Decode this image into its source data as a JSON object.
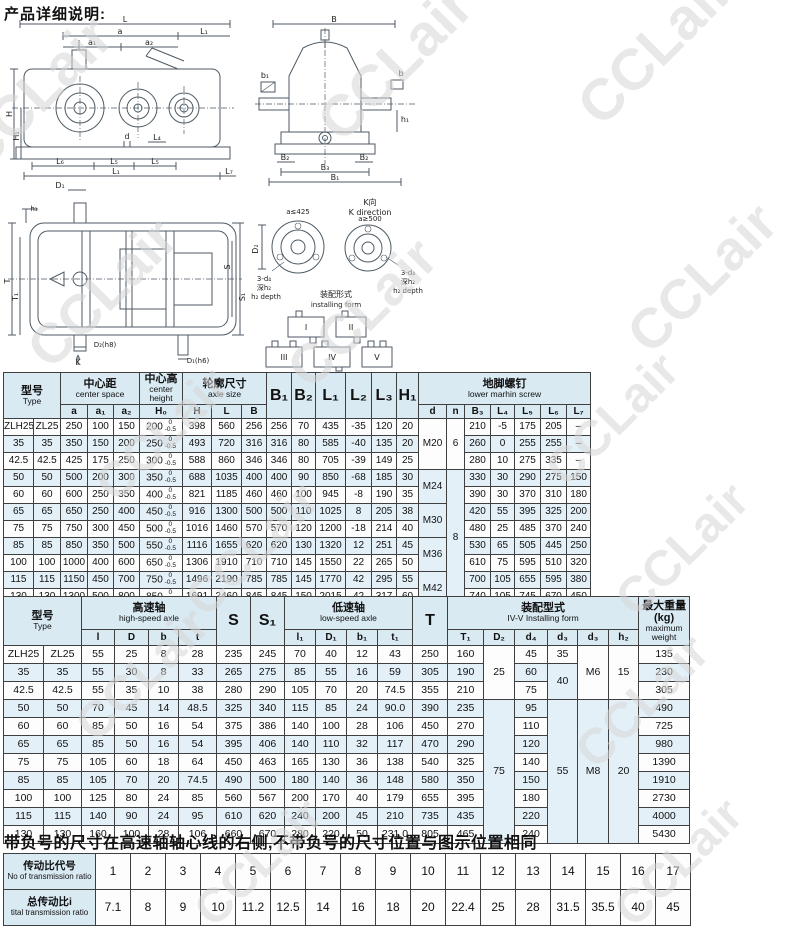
{
  "page": {
    "title": "产品详细说明:"
  },
  "note": "带负号的尺寸在高速轴轴心线的右侧,不带负号的尺寸位置与图示位置相同",
  "watermark": {
    "text": "CCLair",
    "color": "#d7d7d7"
  },
  "drawings": {
    "front": {
      "L": "L",
      "a": "a",
      "a1": "a₁",
      "a2": "a₂",
      "L1": "L₁",
      "H": "H",
      "H1": "H₁",
      "d": "d",
      "L4": "L₄",
      "L6": "L₆",
      "L5": "L₅",
      "L5b": "L₅",
      "L1b": "L₁",
      "L7": "L₇",
      "D1": "D₁"
    },
    "side": {
      "B": "B",
      "b1": "b₁",
      "b": "b",
      "h1": "h₁",
      "B2": "B₂",
      "B2b": "B₂",
      "B3": "B₃",
      "B1": "B₁"
    },
    "top": {
      "T": "T",
      "T1": "T₁",
      "h1": "h₁",
      "D2": "D₂(h8)",
      "K": "K",
      "D1": "D₁(h6)",
      "S": "S",
      "S1": "S₁"
    },
    "kdir": {
      "title_cn": "K向",
      "title_en": "K direction",
      "circle1": "a≤425",
      "circle2": "a≥500",
      "d2": "D₂",
      "note1a": "3-d₄",
      "note1b": "深h₂",
      "note1c": "h₂ depth",
      "note2a": "3-d₄",
      "note2b": "深h₂",
      "note2c": "h₂ depth",
      "caption_cn": "装配形式",
      "caption_en": "installing form",
      "forms": [
        "I",
        "II",
        "III",
        "IV",
        "V"
      ]
    }
  },
  "table1": {
    "head": [
      [
        {
          "cn": "型号",
          "en": "Type",
          "cs": 2,
          "rs": 2
        },
        {
          "cn": "中心距",
          "en": "center space",
          "cs": 3
        },
        {
          "cn": "中心高",
          "en": "center height"
        },
        {
          "cn": "轮廓尺寸",
          "en": "axle size",
          "cs": 3
        },
        {
          "t": "B₁",
          "rs": 2
        },
        {
          "t": "B₂",
          "rs": 2
        },
        {
          "t": "L₁",
          "rs": 2
        },
        {
          "t": "L₂",
          "rs": 2
        },
        {
          "t": "L₃",
          "rs": 2
        },
        {
          "t": "H₁",
          "rs": 2
        },
        {
          "cn": "地脚螺钉",
          "en": "lower marhin screw",
          "cs": 7
        }
      ],
      [
        "a",
        "a₁",
        "a₂",
        "H₀",
        "H",
        "L",
        "B",
        "d",
        "n",
        "B₃",
        "L₄",
        "L₅",
        "L₆",
        "L₇"
      ]
    ],
    "body": [
      [
        "ZLH25",
        "ZL25",
        "250",
        "100",
        "150",
        {
          "t": "200",
          "tol": [
            "0",
            "-0.5"
          ]
        },
        "398",
        "560",
        "256",
        "256",
        "70",
        "435",
        "-35",
        "120",
        "20",
        {
          "t": "M20",
          "rs": 3
        },
        {
          "t": "6",
          "rs": 3
        },
        "210",
        "-5",
        "175",
        "205",
        "–"
      ],
      [
        "35",
        "35",
        "350",
        "150",
        "200",
        {
          "t": "250",
          "tol": [
            "0",
            "-0.5"
          ]
        },
        "493",
        "720",
        "316",
        "316",
        "80",
        "585",
        "-40",
        "135",
        "20",
        "260",
        "0",
        "255",
        "255",
        "–"
      ],
      [
        "42.5",
        "42.5",
        "425",
        "175",
        "250",
        {
          "t": "300",
          "tol": [
            "0",
            "-0.5"
          ]
        },
        "588",
        "860",
        "346",
        "346",
        "80",
        "705",
        "-39",
        "149",
        "25",
        "280",
        "10",
        "275",
        "335",
        "–"
      ],
      [
        "50",
        "50",
        "500",
        "200",
        "300",
        {
          "t": "350",
          "tol": [
            "0",
            "-0.5"
          ]
        },
        "688",
        "1035",
        "400",
        "400",
        "90",
        "850",
        "-68",
        "185",
        "30",
        {
          "t": "M24",
          "rs": 2
        },
        {
          "t": "8",
          "rs": 8
        },
        "330",
        "30",
        "290",
        "275",
        "150"
      ],
      [
        "60",
        "60",
        "600",
        "250",
        "350",
        {
          "t": "400",
          "tol": [
            "0",
            "-0.5"
          ]
        },
        "821",
        "1185",
        "460",
        "460",
        "100",
        "945",
        "-8",
        "190",
        "35",
        "390",
        "30",
        "370",
        "310",
        "180"
      ],
      [
        "65",
        "65",
        "650",
        "250",
        "400",
        {
          "t": "450",
          "tol": [
            "0",
            "-0.5"
          ]
        },
        "916",
        "1300",
        "500",
        "500",
        "110",
        "1025",
        "8",
        "205",
        "38",
        {
          "t": "M30",
          "rs": 2
        },
        "420",
        "55",
        "395",
        "325",
        "200"
      ],
      [
        "75",
        "75",
        "750",
        "300",
        "450",
        {
          "t": "500",
          "tol": [
            "0",
            "-0.5"
          ]
        },
        "1016",
        "1460",
        "570",
        "570",
        "120",
        "1200",
        "-18",
        "214",
        "40",
        "480",
        "25",
        "485",
        "370",
        "240"
      ],
      [
        "85",
        "85",
        "850",
        "350",
        "500",
        {
          "t": "550",
          "tol": [
            "0",
            "-0.5"
          ]
        },
        "1116",
        "1655",
        "620",
        "620",
        "130",
        "1320",
        "12",
        "251",
        "45",
        {
          "t": "M36",
          "rs": 2
        },
        "530",
        "65",
        "505",
        "445",
        "250"
      ],
      [
        "100",
        "100",
        "1000",
        "400",
        "600",
        {
          "t": "650",
          "tol": [
            "0",
            "-0.5"
          ]
        },
        "1306",
        "1910",
        "710",
        "710",
        "145",
        "1550",
        "22",
        "265",
        "50",
        "610",
        "75",
        "595",
        "510",
        "320"
      ],
      [
        "115",
        "115",
        "1150",
        "450",
        "700",
        {
          "t": "750",
          "tol": [
            "0",
            "-0.5"
          ]
        },
        "1496",
        "2190",
        "785",
        "785",
        "145",
        "1770",
        "42",
        "295",
        "55",
        {
          "t": "M42",
          "rs": 2
        },
        "700",
        "105",
        "655",
        "595",
        "380"
      ],
      [
        "130",
        "130",
        "1300",
        "500",
        "800",
        {
          "t": "850",
          "tol": [
            "0",
            "-0.5"
          ]
        },
        "1691",
        "2460",
        "845",
        "845",
        "150",
        "2015",
        "42",
        "317",
        "60",
        "740",
        "105",
        "745",
        "670",
        "450"
      ]
    ]
  },
  "table2": {
    "head": [
      [
        {
          "cn": "型号",
          "en": "Type",
          "cs": 2,
          "rs": 2
        },
        {
          "cn": "高速轴",
          "en": "high-speed axle",
          "cs": 4
        },
        {
          "t": "S",
          "rs": 2
        },
        {
          "t": "S₁",
          "rs": 2
        },
        {
          "cn": "低速轴",
          "en": "low-speed axle",
          "cs": 4
        },
        {
          "t": "T",
          "rs": 2
        },
        {
          "cn": "装配型式",
          "en": "IV-V Installing form",
          "cs": 6
        },
        {
          "cn": "最大重量(kg)",
          "en": "maximum weight",
          "rs": 2
        }
      ],
      [
        "l",
        "D",
        "b",
        "t",
        "l₁",
        "D₁",
        "b₁",
        "t₁",
        "T₁",
        "D₂",
        "d₄",
        "d₃",
        "d₃",
        "h₂"
      ]
    ],
    "body": [
      [
        "ZLH25",
        "ZL25",
        "55",
        "25",
        "8",
        "28",
        "235",
        "245",
        "70",
        "40",
        "12",
        "43",
        "250",
        "160",
        {
          "t": "25",
          "rs": 3
        },
        "45",
        "35",
        {
          "t": "M6",
          "rs": 3
        },
        {
          "t": "15",
          "rs": 3
        },
        "135"
      ],
      [
        "35",
        "35",
        "55",
        "30",
        "8",
        "33",
        "265",
        "275",
        "85",
        "55",
        "16",
        "59",
        "305",
        "190",
        "60",
        {
          "t": "40",
          "rs": 2
        },
        "230"
      ],
      [
        "42.5",
        "42.5",
        "55",
        "35",
        "10",
        "38",
        "280",
        "290",
        "105",
        "70",
        "20",
        "74.5",
        "355",
        "210",
        "75",
        "305"
      ],
      [
        "50",
        "50",
        "70",
        "45",
        "14",
        "48.5",
        "325",
        "340",
        "115",
        "85",
        "24",
        "90.0",
        "390",
        "235",
        {
          "t": "75",
          "rs": 8
        },
        "95",
        {
          "t": "55",
          "rs": 8
        },
        {
          "t": "M8",
          "rs": 8
        },
        {
          "t": "20",
          "rs": 8
        },
        "490"
      ],
      [
        "60",
        "60",
        "85",
        "50",
        "16",
        "54",
        "375",
        "386",
        "140",
        "100",
        "28",
        "106",
        "450",
        "270",
        "110",
        "725"
      ],
      [
        "65",
        "65",
        "85",
        "50",
        "16",
        "54",
        "395",
        "406",
        "140",
        "110",
        "32",
        "117",
        "470",
        "290",
        "120",
        "980"
      ],
      [
        "75",
        "75",
        "105",
        "60",
        "18",
        "64",
        "450",
        "463",
        "165",
        "130",
        "36",
        "138",
        "540",
        "325",
        "140",
        "1390"
      ],
      [
        "85",
        "85",
        "105",
        "70",
        "20",
        "74.5",
        "490",
        "500",
        "180",
        "140",
        "36",
        "148",
        "580",
        "350",
        "150",
        "1910"
      ],
      [
        "100",
        "100",
        "125",
        "80",
        "24",
        "85",
        "560",
        "567",
        "200",
        "170",
        "40",
        "179",
        "655",
        "395",
        "180",
        "2730"
      ],
      [
        "115",
        "115",
        "140",
        "90",
        "24",
        "95",
        "610",
        "620",
        "240",
        "200",
        "45",
        "210",
        "735",
        "435",
        "220",
        "4000"
      ],
      [
        "130",
        "130",
        "160",
        "100",
        "28",
        "106",
        "660",
        "670",
        "280",
        "220",
        "50",
        "231.0",
        "805",
        "465",
        "240",
        "5430"
      ]
    ]
  },
  "table3": {
    "body": [
      [
        {
          "cn": "传动比代号",
          "en": "No of transmission ratio",
          "h": true
        },
        "1",
        "2",
        "3",
        "4",
        "5",
        "6",
        "7",
        "8",
        "9",
        "10",
        "11",
        "12",
        "13",
        "14",
        "15",
        "16",
        "17"
      ],
      [
        {
          "cn": "总传动比i",
          "en": "tital transmission ratio",
          "h": true
        },
        "7.1",
        "8",
        "9",
        "10",
        "11.2",
        "12.5",
        "14",
        "16",
        "18",
        "20",
        "22.4",
        "25",
        "28",
        "31.5",
        "35.5",
        "40",
        "45"
      ]
    ]
  }
}
